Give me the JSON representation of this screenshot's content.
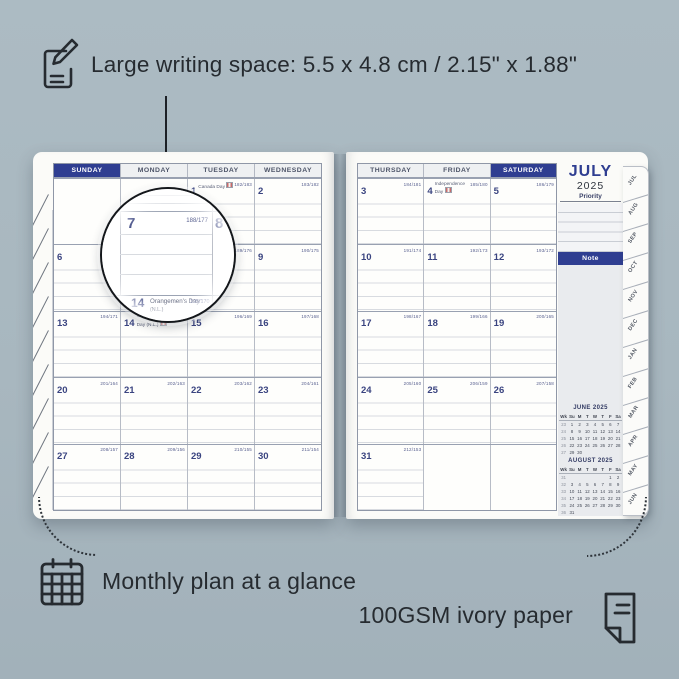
{
  "colors": {
    "background": "#a8b7bf",
    "navy": "#2f3e91",
    "ink": "#262b30",
    "paper": "#fbfbf8"
  },
  "annotations": {
    "top": {
      "icon": "pencil-note-icon",
      "text": "Large writing space: 5.5 x 4.8 cm / 2.15\" x 1.88\""
    },
    "bottom_left": {
      "icon": "calendar-grid-icon",
      "text": "Monthly plan at a glance"
    },
    "bottom_right": {
      "icon": "paper-sheet-icon",
      "text": "100GSM ivory paper"
    }
  },
  "planner": {
    "left_page": {
      "headers": [
        "SUNDAY",
        "MONDAY",
        "TUESDAY",
        "WEDNESDAY"
      ],
      "accent_header": 0,
      "rows": [
        [
          {
            "day": "",
            "doy": "",
            "holiday": ""
          },
          {
            "day": "",
            "doy": "",
            "holiday": ""
          },
          {
            "day": "1",
            "doy": "182/183",
            "holiday": "Canada Day",
            "flag": true
          },
          {
            "day": "2",
            "doy": "183/182",
            "holiday": ""
          }
        ],
        [
          {
            "day": "6",
            "doy": "187/178",
            "holiday": ""
          },
          {
            "day": "7",
            "doy": "188/177",
            "holiday": ""
          },
          {
            "day": "8",
            "doy": "189/176",
            "holiday": ""
          },
          {
            "day": "9",
            "doy": "190/175",
            "holiday": ""
          }
        ],
        [
          {
            "day": "13",
            "doy": "194/171",
            "holiday": ""
          },
          {
            "day": "14",
            "doy": "195/170",
            "holiday": "Orangemen's Day (N.L.)",
            "flag": true
          },
          {
            "day": "15",
            "doy": "196/169",
            "holiday": ""
          },
          {
            "day": "16",
            "doy": "197/168",
            "holiday": ""
          }
        ],
        [
          {
            "day": "20",
            "doy": "201/164",
            "holiday": ""
          },
          {
            "day": "21",
            "doy": "202/163",
            "holiday": ""
          },
          {
            "day": "22",
            "doy": "203/162",
            "holiday": ""
          },
          {
            "day": "23",
            "doy": "204/161",
            "holiday": ""
          }
        ],
        [
          {
            "day": "27",
            "doy": "208/157",
            "holiday": ""
          },
          {
            "day": "28",
            "doy": "209/156",
            "holiday": ""
          },
          {
            "day": "29",
            "doy": "210/155",
            "holiday": ""
          },
          {
            "day": "30",
            "doy": "211/154",
            "holiday": ""
          }
        ]
      ]
    },
    "right_page": {
      "headers": [
        "THURSDAY",
        "FRIDAY",
        "SATURDAY"
      ],
      "accent_header": 2,
      "rows": [
        [
          {
            "day": "3",
            "doy": "184/181",
            "holiday": ""
          },
          {
            "day": "4",
            "doy": "185/180",
            "holiday": "Independence Day",
            "flag": true
          },
          {
            "day": "5",
            "doy": "186/179",
            "holiday": ""
          }
        ],
        [
          {
            "day": "10",
            "doy": "191/174",
            "holiday": ""
          },
          {
            "day": "11",
            "doy": "192/173",
            "holiday": ""
          },
          {
            "day": "12",
            "doy": "193/172",
            "holiday": ""
          }
        ],
        [
          {
            "day": "17",
            "doy": "198/167",
            "holiday": ""
          },
          {
            "day": "18",
            "doy": "199/166",
            "holiday": ""
          },
          {
            "day": "19",
            "doy": "200/165",
            "holiday": ""
          }
        ],
        [
          {
            "day": "24",
            "doy": "205/160",
            "holiday": ""
          },
          {
            "day": "25",
            "doy": "206/159",
            "holiday": ""
          },
          {
            "day": "26",
            "doy": "207/158",
            "holiday": ""
          }
        ],
        [
          {
            "day": "31",
            "doy": "212/153",
            "holiday": ""
          },
          {
            "day": "",
            "doy": "",
            "holiday": ""
          },
          {
            "day": "",
            "doy": "",
            "holiday": ""
          }
        ]
      ]
    },
    "sidebar": {
      "month": "JULY",
      "year": "2025",
      "priority_label": "Priority",
      "note_label": "Note",
      "mini_calendars": [
        {
          "title": "JUNE 2025",
          "head": [
            "Wk",
            "Su",
            "M",
            "T",
            "W",
            "T",
            "F",
            "Sa"
          ],
          "rows": [
            [
              "23",
              "1",
              "2",
              "3",
              "4",
              "5",
              "6",
              "7"
            ],
            [
              "24",
              "8",
              "9",
              "10",
              "11",
              "12",
              "13",
              "14"
            ],
            [
              "25",
              "15",
              "16",
              "17",
              "18",
              "19",
              "20",
              "21"
            ],
            [
              "26",
              "22",
              "23",
              "24",
              "25",
              "26",
              "27",
              "28"
            ],
            [
              "27",
              "29",
              "30",
              "",
              "",
              "",
              "",
              ""
            ]
          ]
        },
        {
          "title": "AUGUST 2025",
          "head": [
            "Wk",
            "Su",
            "M",
            "T",
            "W",
            "T",
            "F",
            "Sa"
          ],
          "rows": [
            [
              "31",
              "",
              "",
              "",
              "",
              "",
              "1",
              "2"
            ],
            [
              "32",
              "3",
              "4",
              "5",
              "6",
              "7",
              "8",
              "9"
            ],
            [
              "33",
              "10",
              "11",
              "12",
              "13",
              "14",
              "15",
              "16"
            ],
            [
              "34",
              "17",
              "18",
              "19",
              "20",
              "21",
              "22",
              "23"
            ],
            [
              "35",
              "24",
              "25",
              "26",
              "27",
              "28",
              "29",
              "30"
            ],
            [
              "36",
              "31",
              "",
              "",
              "",
              "",
              "",
              ""
            ]
          ]
        }
      ]
    },
    "tabs": [
      "JUL",
      "AUG",
      "SEP",
      "OCT",
      "NOV",
      "DEC",
      "JAN",
      "FEB",
      "MAR",
      "APR",
      "MAY",
      "JUN"
    ],
    "magnifier": {
      "day": "7",
      "doy": "188/177",
      "next_day": "8",
      "below_day": "14",
      "below_holiday": "Orangemen's Day",
      "below_holiday_note": "(N.L.)",
      "below_doy": "195/170"
    }
  }
}
